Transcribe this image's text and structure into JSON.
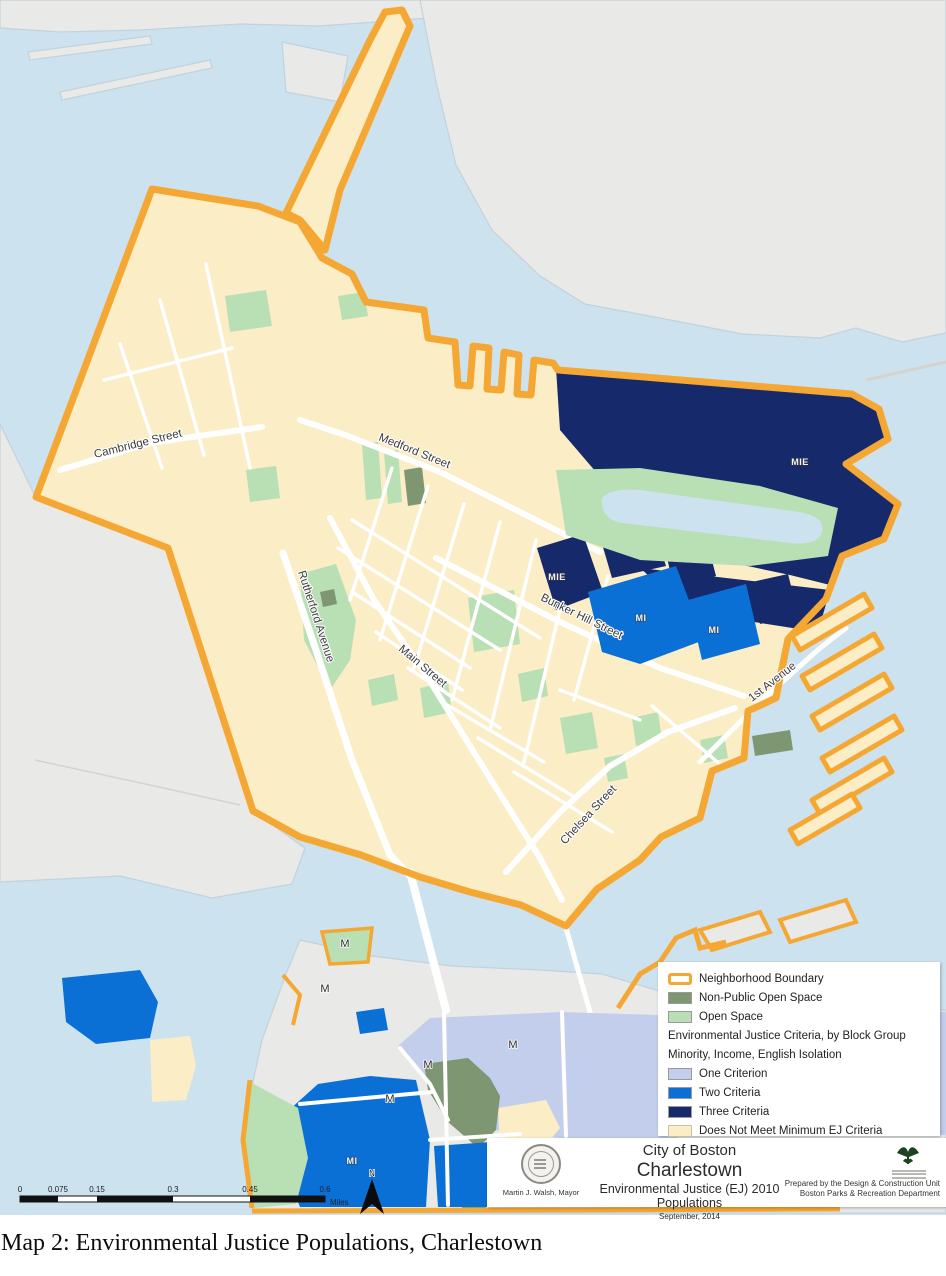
{
  "caption": "Map 2:  Environmental Justice Populations, Charlestown",
  "map": {
    "streets": {
      "cambridge": "Cambridge Street",
      "medford": "Medford Street",
      "rutherford": "Rutherford Avenue",
      "main": "Main Street",
      "bunker_hill": "Bunker Hill Street",
      "chelsea": "Chelsea Street",
      "first_avenue": "1st Avenue"
    },
    "block_codes": {
      "one": "M",
      "two": "MI",
      "three": "MIE"
    }
  },
  "legend": {
    "items": [
      {
        "label": "Neighborhood Boundary"
      },
      {
        "label": "Non-Public Open Space"
      },
      {
        "label": "Open Space"
      },
      {
        "label": "One Criterion"
      },
      {
        "label": "Two Criteria"
      },
      {
        "label": "Three Criteria"
      },
      {
        "label": "Does Not Meet Minimum EJ Criteria"
      }
    ],
    "section_header_line1": "Environmental Justice Criteria, by Block Group",
    "section_header_line2": "Minority, Income, English Isolation"
  },
  "title_block": {
    "city": "City of Boston",
    "neighborhood": "Charlestown",
    "subtitle": "Environmental Justice (EJ) 2010 Populations",
    "date": "September, 2014",
    "mayor": "Martin J. Walsh, Mayor",
    "prepared_line1": "Prepared by the Design & Construction Unit",
    "prepared_line2": "Boston Parks & Recreation Department"
  },
  "scale_bar": {
    "ticks": [
      "0",
      "0.075",
      "0.15",
      "0.3",
      "0.45",
      "0.6"
    ],
    "unit": "Miles"
  },
  "north_label": "N",
  "colors": {
    "boundary_orange": "#F5A733",
    "three_criteria_navy": "#15296B",
    "two_criteria_blue": "#0B70D6",
    "one_criterion_periwinkle": "#C3CEEC",
    "no_criteria_cream": "#FBEDC5",
    "open_space_green": "#B9DFB4",
    "nonpublic_open_sage": "#7E9671",
    "water": "#CDE2EF",
    "land": "#E9E9E7"
  }
}
